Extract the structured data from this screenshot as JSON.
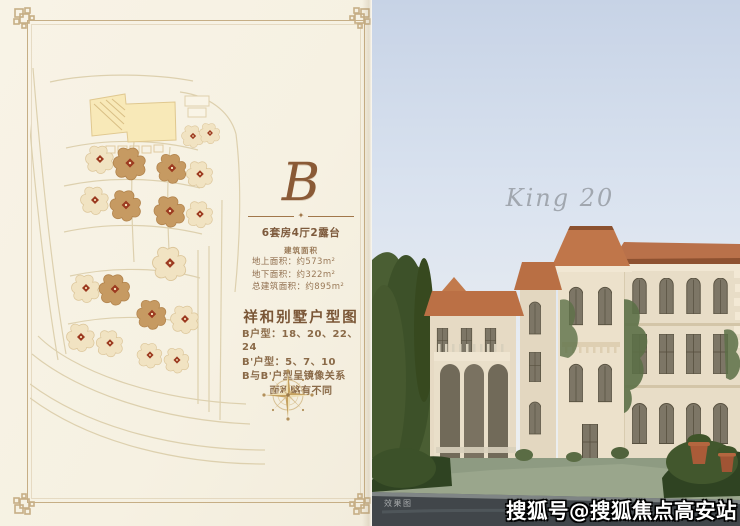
{
  "brochure": {
    "monogram": "B",
    "divider_ornament": "✦",
    "unit_type": "6套房4厅2露台",
    "area_section_label": "建筑面积",
    "areas": [
      {
        "label": "地上面积：",
        "value": "约573m²"
      },
      {
        "label": "地下面积：",
        "value": "约322m²"
      },
      {
        "label": "总建筑面积：",
        "value": "约895m²"
      }
    ],
    "plan_heading": "祥和别墅户型图",
    "plan_notes": [
      "B户型：18、20、22、24",
      "B'户型：5、7、10",
      "B与B'户型呈镜像关系",
      "面积略有不同"
    ]
  },
  "photo": {
    "script_title": "King 20",
    "corner_label": "效果图",
    "watermark": "搜狐号@搜狐焦点高安站"
  },
  "site_plan": {
    "villa_pale_fill": "#f1e3c2",
    "villa_pale_stroke": "#dcc69a",
    "villa_dark_fill": "#c69a62",
    "villa_dark_stroke": "#b3854e",
    "marker_color": "#9c3a20",
    "villas": [
      {
        "x": 163,
        "y": 84,
        "tone": "pale",
        "s": 0.75
      },
      {
        "x": 180,
        "y": 81,
        "tone": "pale",
        "s": 0.7
      },
      {
        "x": 70,
        "y": 107,
        "tone": "pale",
        "s": 0.95
      },
      {
        "x": 100,
        "y": 111,
        "tone": "dark",
        "s": 1.1
      },
      {
        "x": 142,
        "y": 116,
        "tone": "dark",
        "s": 1.0
      },
      {
        "x": 170,
        "y": 122,
        "tone": "pale",
        "s": 0.9
      },
      {
        "x": 65,
        "y": 148,
        "tone": "pale",
        "s": 0.95
      },
      {
        "x": 96,
        "y": 153,
        "tone": "dark",
        "s": 1.05
      },
      {
        "x": 140,
        "y": 159,
        "tone": "dark",
        "s": 1.05
      },
      {
        "x": 170,
        "y": 162,
        "tone": "pale",
        "s": 0.9
      },
      {
        "x": 140,
        "y": 211,
        "tone": "pale",
        "s": 1.15
      },
      {
        "x": 56,
        "y": 236,
        "tone": "pale",
        "s": 0.95
      },
      {
        "x": 85,
        "y": 237,
        "tone": "dark",
        "s": 1.05
      },
      {
        "x": 122,
        "y": 262,
        "tone": "dark",
        "s": 1.0
      },
      {
        "x": 155,
        "y": 267,
        "tone": "pale",
        "s": 0.95
      },
      {
        "x": 51,
        "y": 285,
        "tone": "pale",
        "s": 0.95
      },
      {
        "x": 80,
        "y": 291,
        "tone": "pale",
        "s": 0.9
      },
      {
        "x": 120,
        "y": 303,
        "tone": "pale",
        "s": 0.85
      },
      {
        "x": 147,
        "y": 308,
        "tone": "pale",
        "s": 0.85
      }
    ]
  },
  "colors": {
    "page_bg": "#f7f2e4",
    "frame": "#c6ae85",
    "text_brown": "#8a6244",
    "accent_red": "#9c3a20",
    "roof_terracotta": "#bb7045",
    "stone_cream": "#e8ddc7",
    "sky_blue": "#c7d3e6"
  }
}
